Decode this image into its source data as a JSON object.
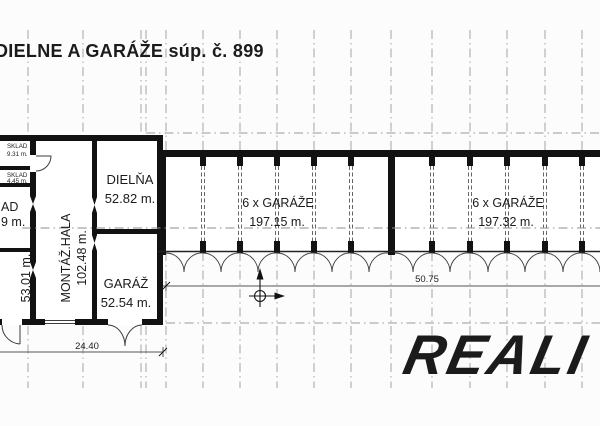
{
  "header": {
    "title": "DIELNE A GARÁŽE súp. č. 899"
  },
  "rooms": {
    "sklad1": {
      "name": "SKLAD",
      "area": "9.31 m."
    },
    "sklad2": {
      "name": "SKLAD",
      "area": "4.45 m."
    },
    "sklad3": {
      "name_fragment": "AD",
      "area_fragment": "9 m."
    },
    "room53": {
      "area": "53.01 m."
    },
    "hala": {
      "name": "MONTÁŽ.HALA",
      "area": "102.48 m."
    },
    "dielna": {
      "name": "DIELŇA",
      "area": "52.82 m."
    },
    "garaz": {
      "name": "GARÁŽ",
      "area": "52.54 m."
    },
    "garaze1": {
      "name": "6 x GARÁŽE",
      "area": "197.15 m."
    },
    "garaze2": {
      "name": "6 x GARÁŽE",
      "area": "197.32 m."
    }
  },
  "dimensions": {
    "building_width": "24.40",
    "garages_width": "50.75"
  },
  "logo": {
    "text": "REALI",
    "color": "#e2242e"
  },
  "colors": {
    "wall": "#121212",
    "thin_line": "#444444",
    "grid_line": "#9a9a9a",
    "background": "#fcfcfc"
  }
}
